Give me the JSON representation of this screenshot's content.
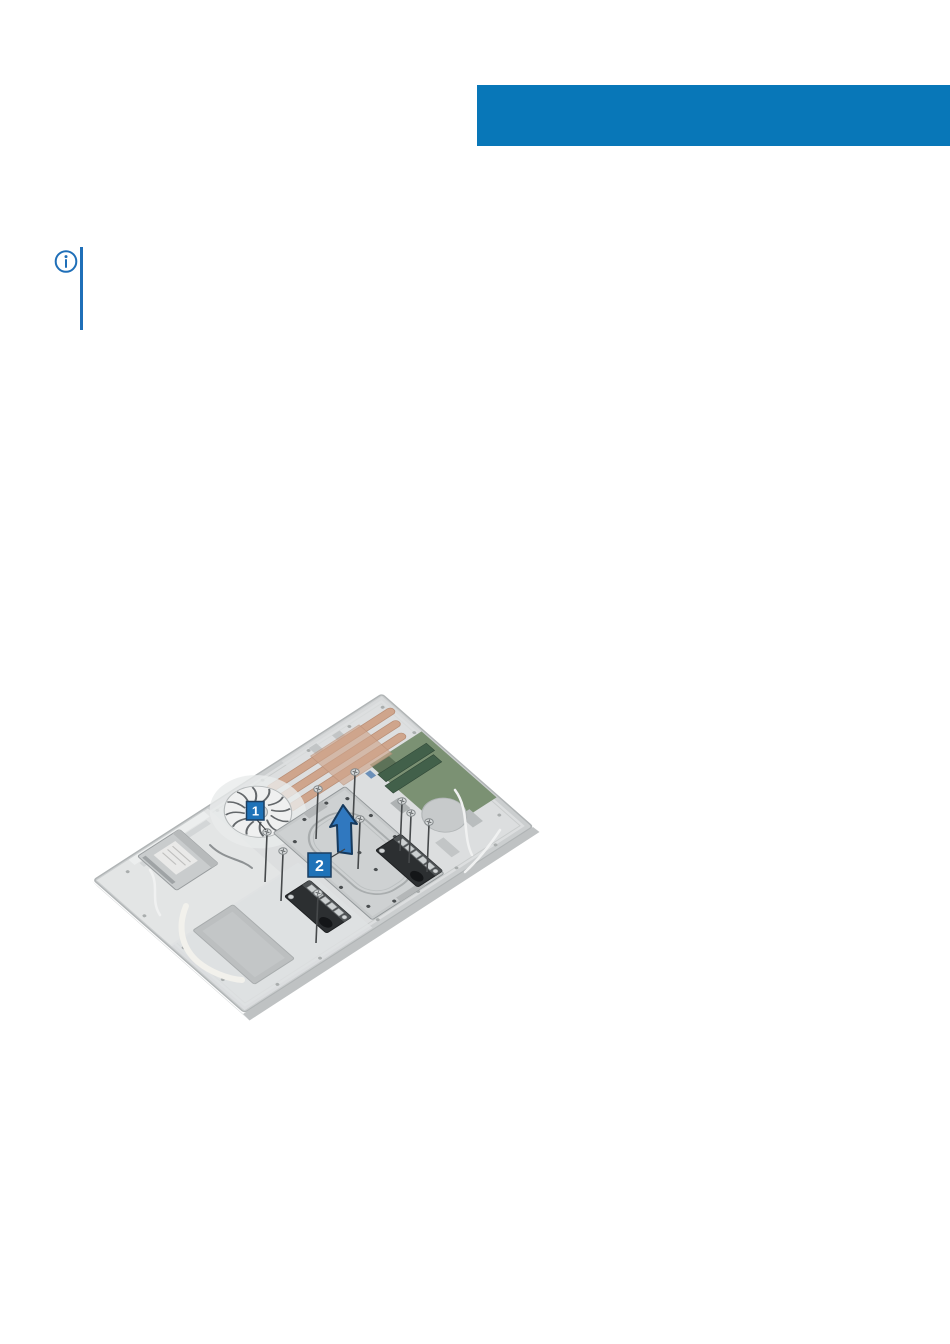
{
  "colors": {
    "background": "#ffffff",
    "header_band": "#0877b8",
    "note_accent": "#1f6fb8",
    "callout_blue": "#1e72b8",
    "arrow_fill": "#3078bf",
    "heatsink_copper": "#cfa58c",
    "pcb_green": "#7b9173"
  },
  "note": {
    "icon": "info-icon"
  },
  "figure": {
    "callouts": [
      {
        "label": "1"
      },
      {
        "label": "2"
      }
    ]
  }
}
